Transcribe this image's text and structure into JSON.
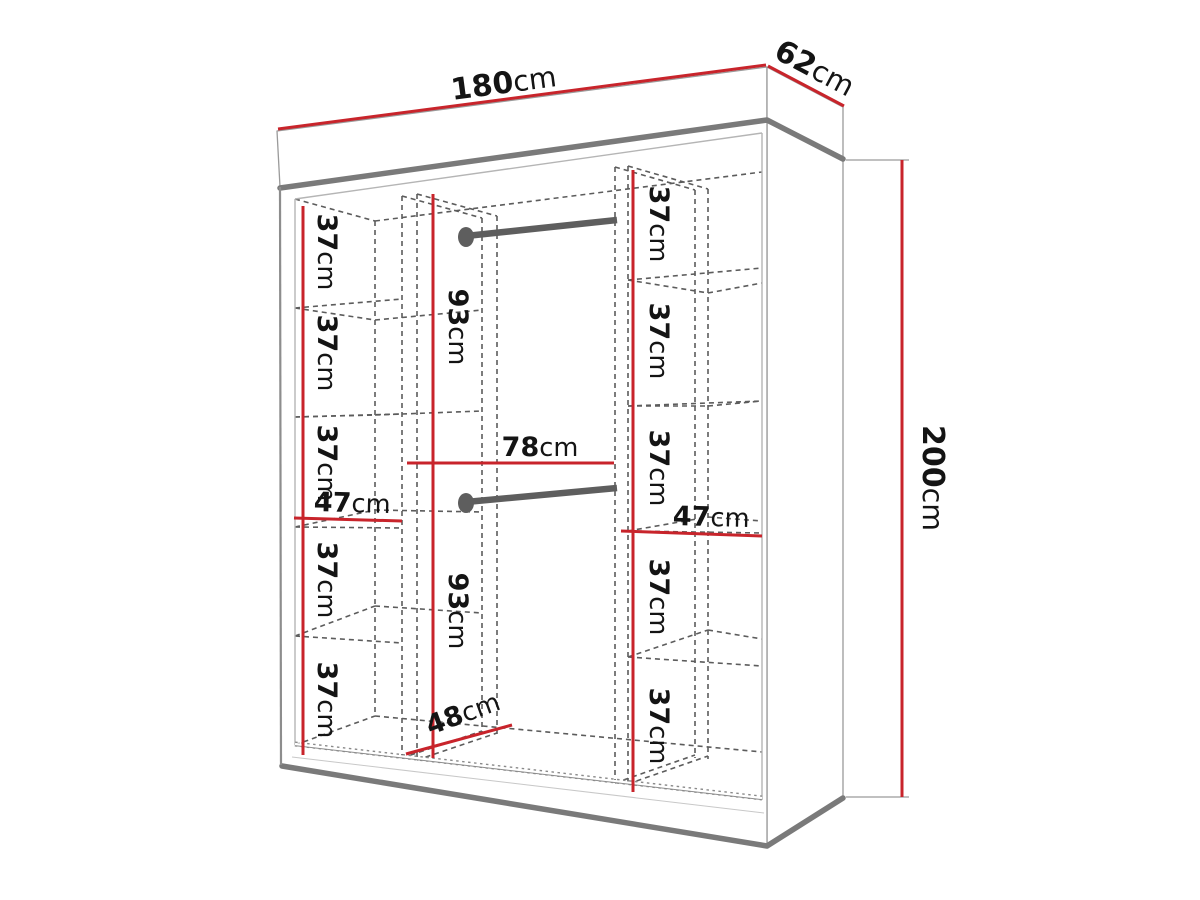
{
  "title": "Wardrobe dimension diagram",
  "unit": "cm",
  "colors": {
    "dimension_line": "#c8242b",
    "outline": "#7a7a7a",
    "hidden_line": "#5c5c5c",
    "text": "#141414"
  },
  "overall": {
    "width": "180",
    "depth": "62",
    "height": "200"
  },
  "left_column": {
    "width": "47",
    "sections": [
      "37",
      "37",
      "37",
      "37",
      "37"
    ]
  },
  "center_column": {
    "width": "78",
    "upper_hanging_height": "93",
    "lower_hanging_height": "93",
    "floor_depth": "48"
  },
  "right_column": {
    "width": "47",
    "sections": [
      "37",
      "37",
      "37",
      "37",
      "37"
    ]
  }
}
